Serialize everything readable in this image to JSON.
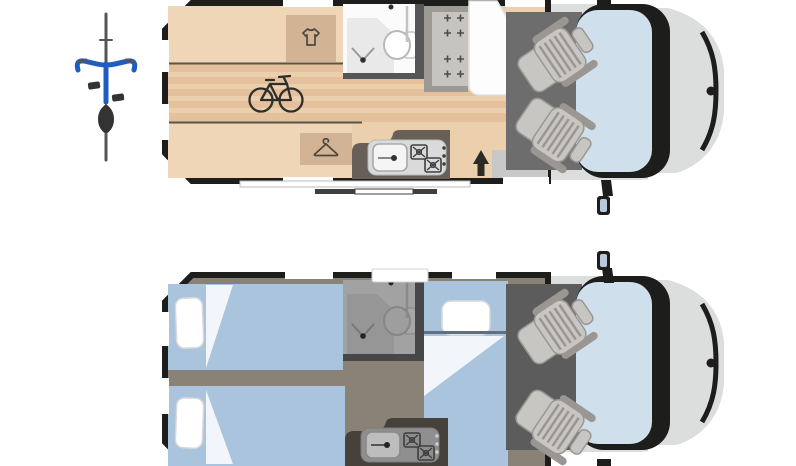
{
  "meta": {
    "title": "Camper van floor plan diagram - day layout (top) and night layout (bottom), top view",
    "views": [
      "day-layout",
      "night-layout"
    ],
    "text_content": "none - purely graphical floor plan"
  },
  "palette": {
    "outline": "#1d1d1b",
    "wood": "#ecd0ae",
    "wood-stripe": "#e4c19c",
    "platform": "#efd6b6",
    "cabinet": "#d2b494",
    "icon-dark": "#4c473c",
    "counter": "#675f58",
    "counter-night": "#46413b",
    "inset": "#dadada",
    "inset-night": "#8f8f8f",
    "sink": "#f5f5f5",
    "sink-night": "#bdbdbd",
    "bath": "#fbfbfb",
    "bath-night": "#a2a2a2",
    "bath-wall": "#55565a",
    "bath-wall-night": "#474749",
    "tray": "#e9e9e9",
    "tray-night": "#969696",
    "bench": "#c6c4c0",
    "bench-dark": "#9d9a95",
    "table": "#fdfdfd",
    "cab-floor": "#6d6d6d",
    "cab-floor-night": "#5c5c5c",
    "seat": "#c8c6c2",
    "seat-edge": "#9a9793",
    "glass": "#cfdfeb",
    "hood": "#dcdddd",
    "bed": "#a9c4dc",
    "aisle": "#8a8177",
    "fold": "#f2f6fa",
    "step": "#c8c8c8",
    "bike-blue": "#1e5ec2"
  },
  "day_layout": {
    "features": [
      "exterior-bicycle-symbol",
      "rear-garage-with-bicycle",
      "wardrobe-with-shirt-icon",
      "wardrobe-with-hanger-icon",
      "bathroom-shower-and-wc",
      "dinette-bench-seat",
      "table",
      "kitchen-sink",
      "two-burner-hob",
      "entrance-arrow",
      "entry-step",
      "swivel-passenger-seat",
      "swivel-driver-seat",
      "windshield",
      "side-mirror"
    ]
  },
  "night_layout": {
    "features": [
      "rear-single-bed-left-with-pillow",
      "rear-single-bed-right-with-pillow",
      "front-longitudinal-bed-with-pillow",
      "center-aisle",
      "bathroom-shower-and-wc",
      "kitchen-two-burner-hob",
      "swivel-passenger-seat",
      "swivel-driver-seat",
      "windshield",
      "side-mirror",
      "roof-window"
    ]
  }
}
